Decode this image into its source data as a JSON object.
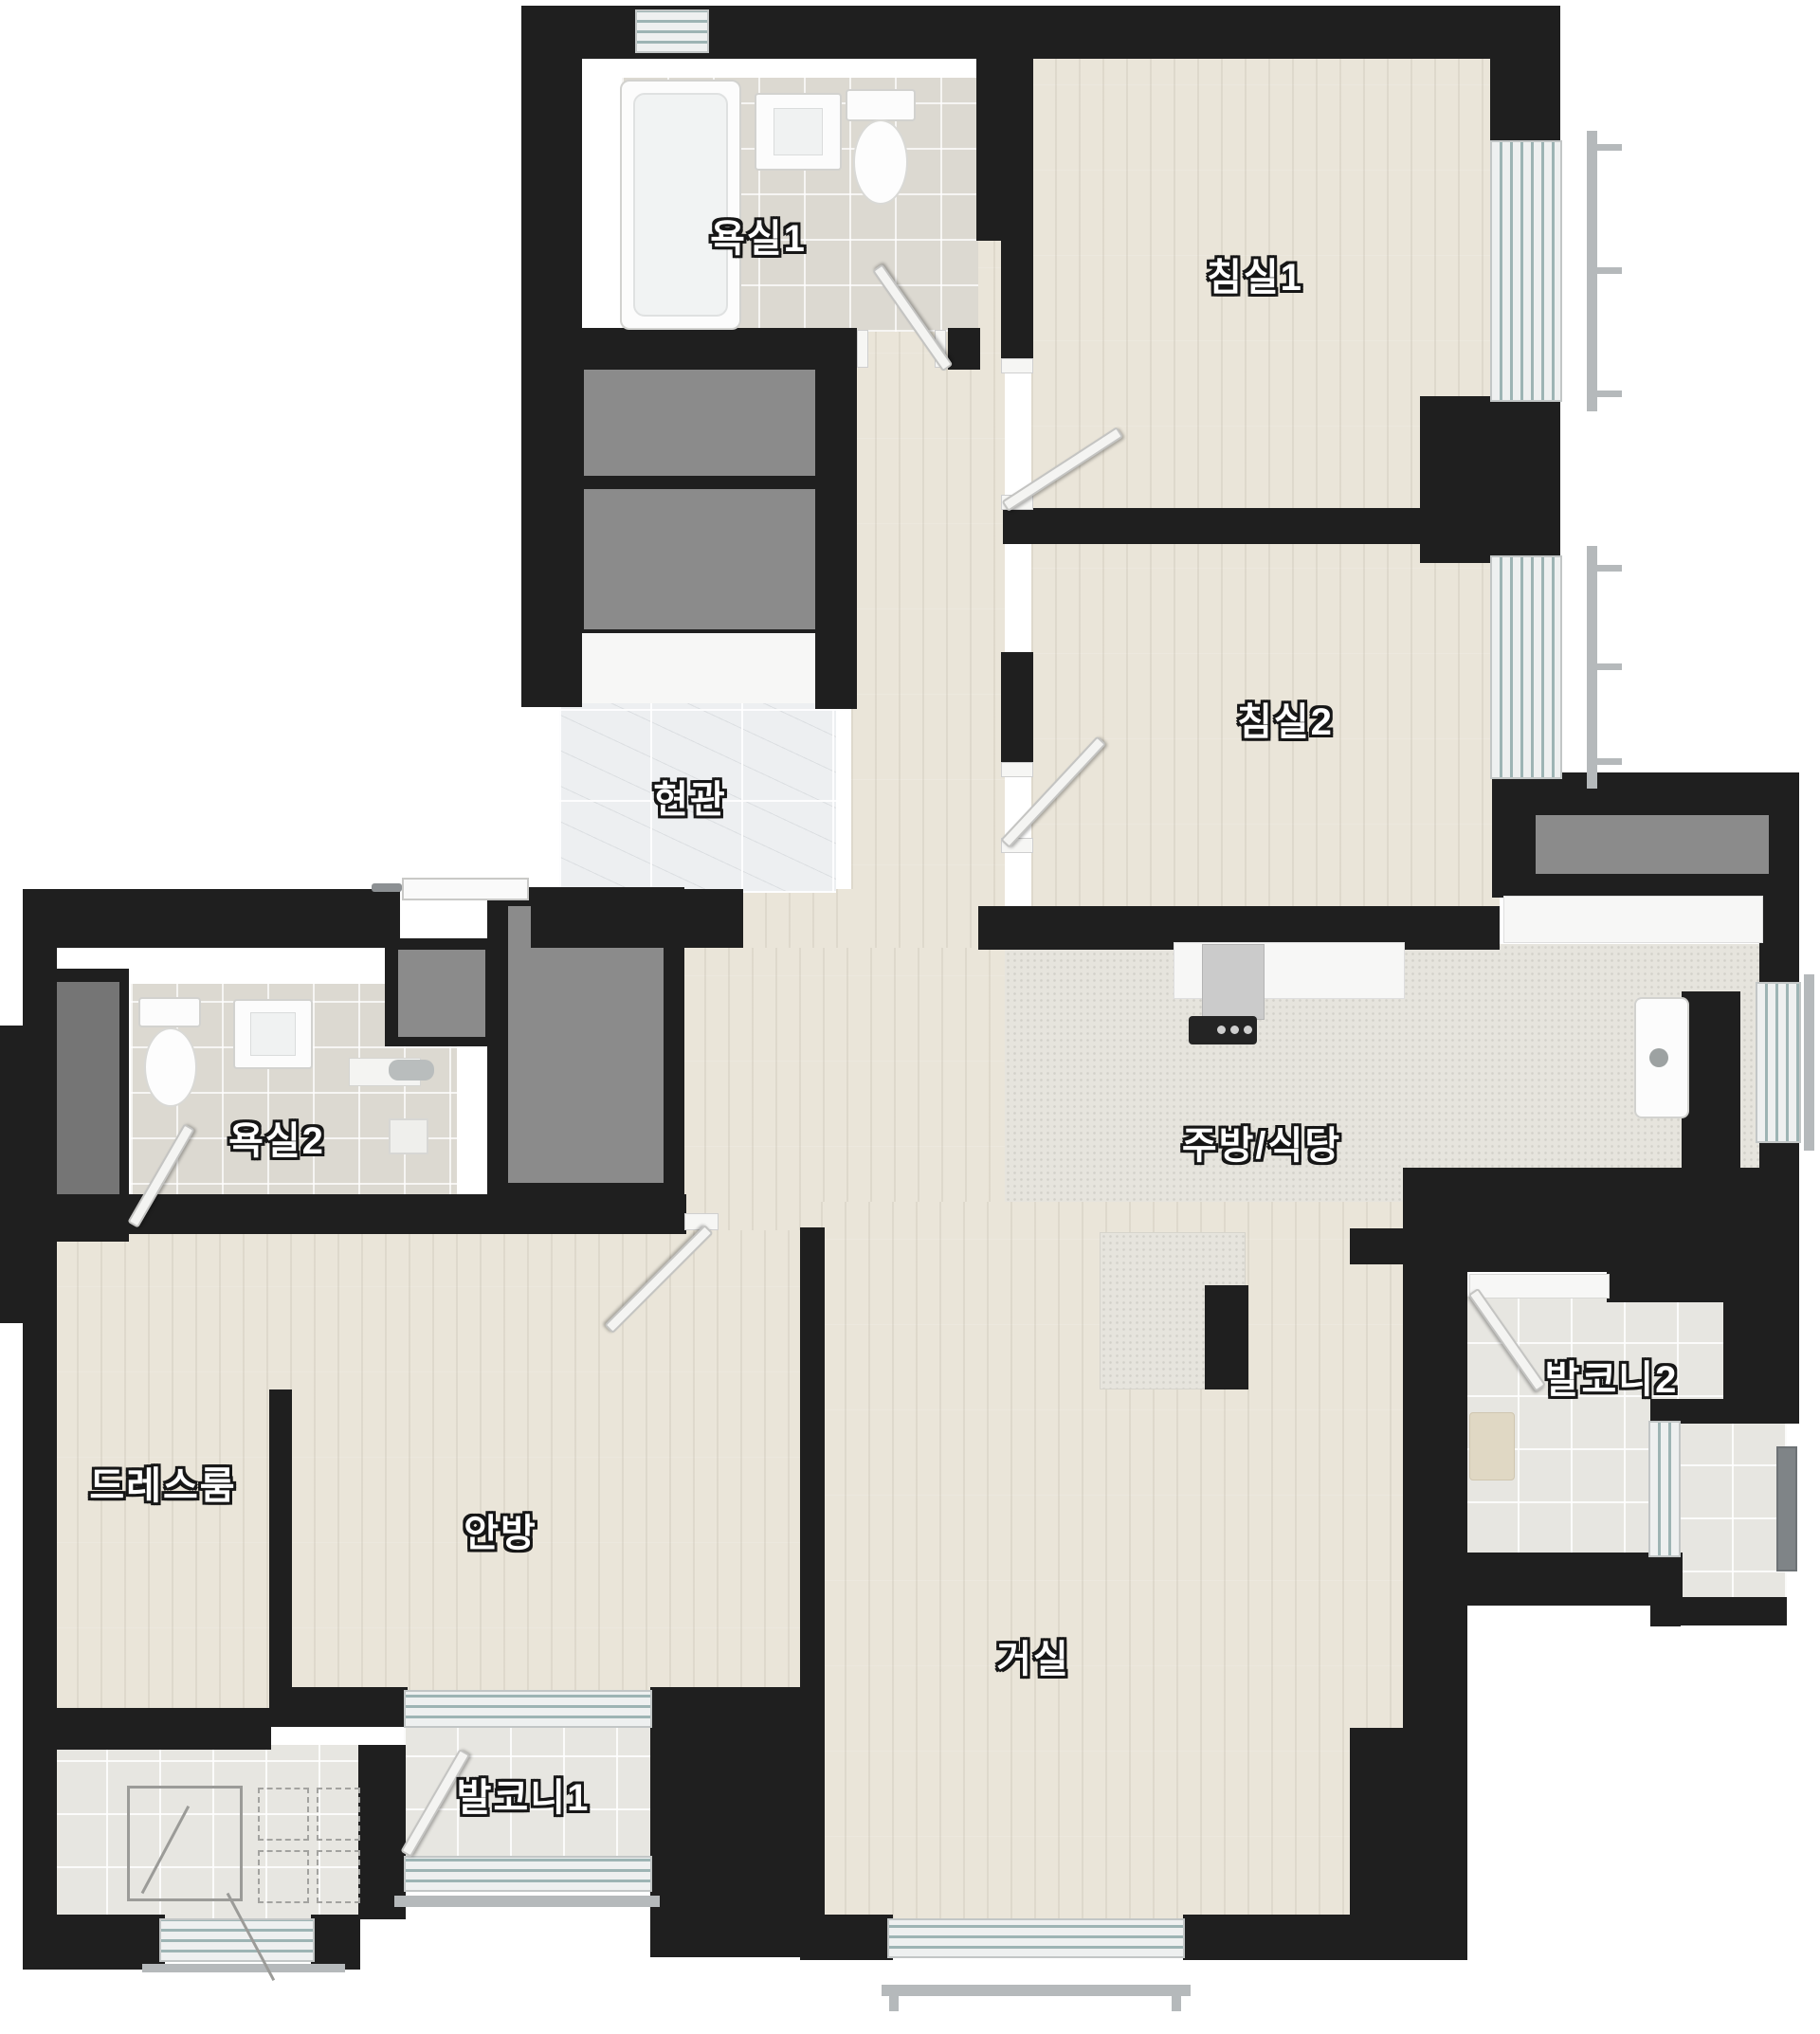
{
  "plan_title": "아파트 평면도",
  "labels": {
    "bath1": "욕실1",
    "bed1": "침실1",
    "entry": "현관",
    "bed2": "침실2",
    "bath2": "욕실2",
    "kitchen": "주방/식당",
    "dress": "드레스룸",
    "master": "안방",
    "balcony2": "발코니2",
    "living": "거실",
    "balcony1": "발코니1"
  },
  "colors": {
    "wall": "#1f1f1f",
    "wood_floor": "#eae5d9",
    "bath_tile": "#dcd9d1",
    "balcony_tile": "#e7e6e1",
    "entry_marble": "#edeff1",
    "kitchen_floor": "#e6e4dd",
    "closet_gray": "#8b8b8b",
    "window_glass": "#9db4b4",
    "railing": "#b5b9bb",
    "label_text": "#ffffff",
    "label_outline": "#161616"
  },
  "fixtures": [
    "bathtub",
    "sink",
    "toilet",
    "shower",
    "range-hood",
    "cooktop",
    "kitchen-sink",
    "kitchen-island",
    "washer-area",
    "wardrobe-closets",
    "window",
    "balcony-railing",
    "door-swing"
  ]
}
